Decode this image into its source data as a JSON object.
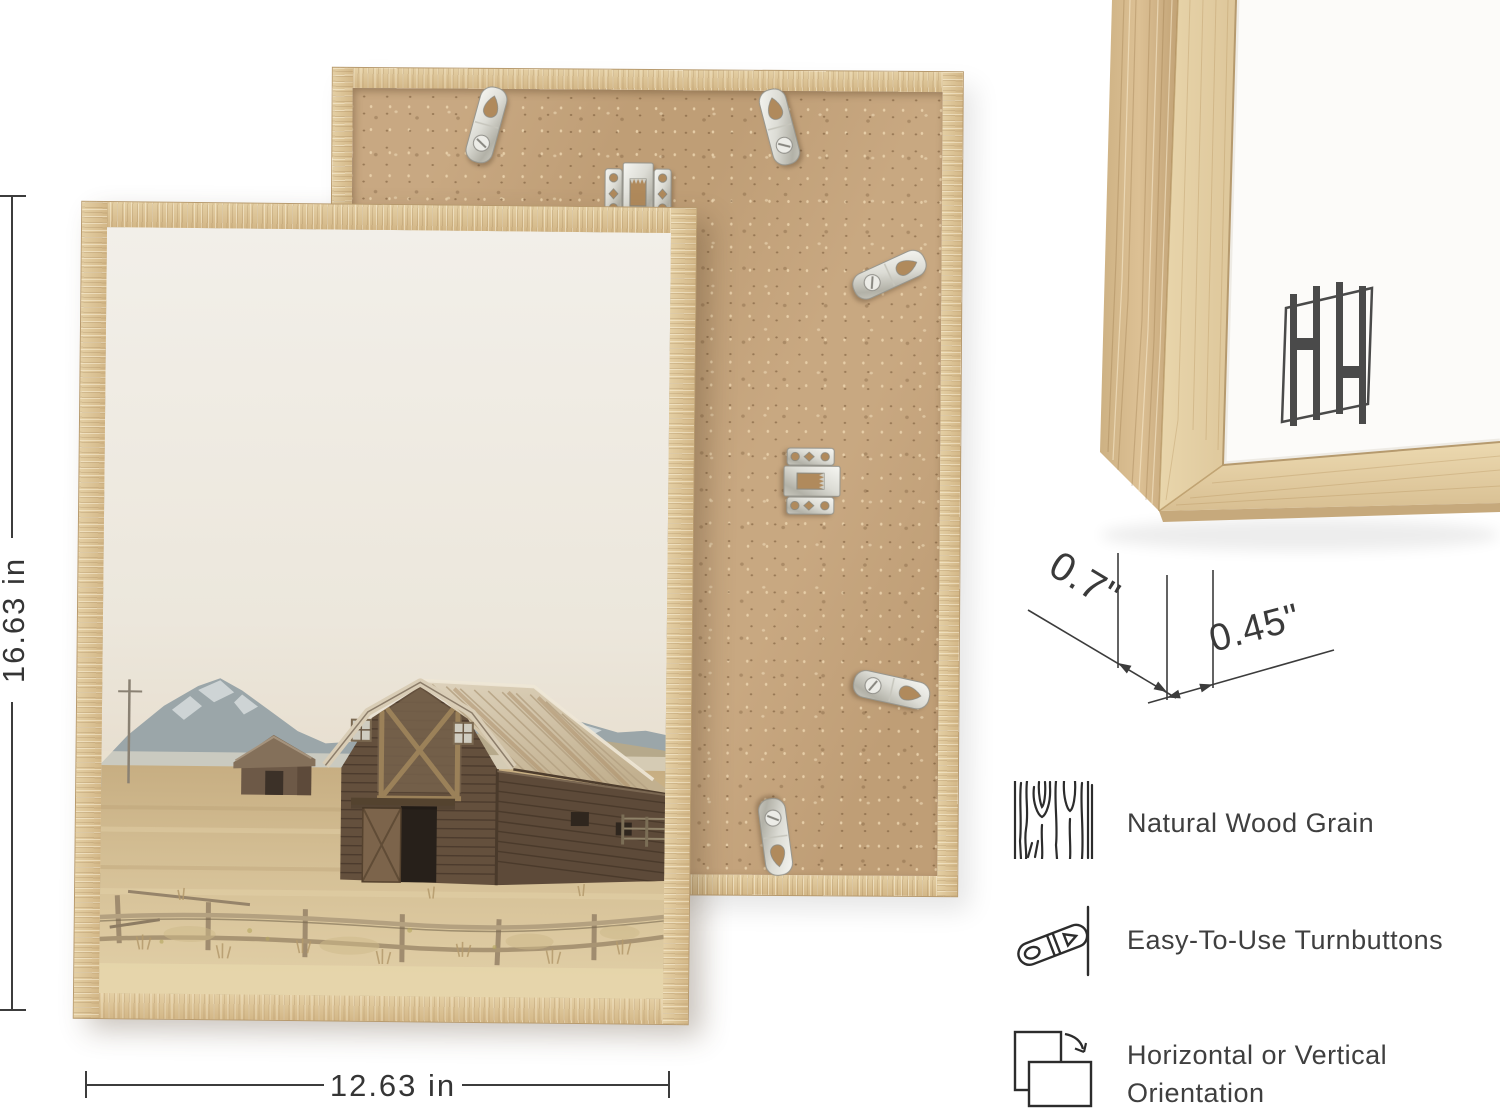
{
  "image_type": "picture-frame-product-infographic",
  "dimensions": {
    "height_label": "16.63 in",
    "width_label": "12.63 in",
    "depth_label": "0.7\"",
    "face_label": "0.45\""
  },
  "features": {
    "row1": {
      "icon": "wood-grain-icon",
      "label": "Natural Wood Grain"
    },
    "row2": {
      "icon": "turnbutton-icon",
      "label": "Easy-To-Use Turnbuttons"
    },
    "row3": {
      "icon": "orientation-icon",
      "line1": "Horizontal or Vertical",
      "line2": "Orientation"
    }
  },
  "palette": {
    "background": "#ffffff",
    "frame_wood_light": "#e7d3a9",
    "frame_wood": "#d8bf93",
    "frame_wood_dark": "#c1a274",
    "mdf_back": "#c5a37a",
    "metal_hardware": "#d9d9d2",
    "annotation_line": "#3c3c3c",
    "annotation_text": "#3a3a3a",
    "logo_color": "#4a4a4a",
    "photo": {
      "sky": "#f0ece4",
      "mountains": "#9ba6a9",
      "field": "#d5c096",
      "barn_wood": "#64503d",
      "barn_roof": "#d3c7af"
    }
  }
}
